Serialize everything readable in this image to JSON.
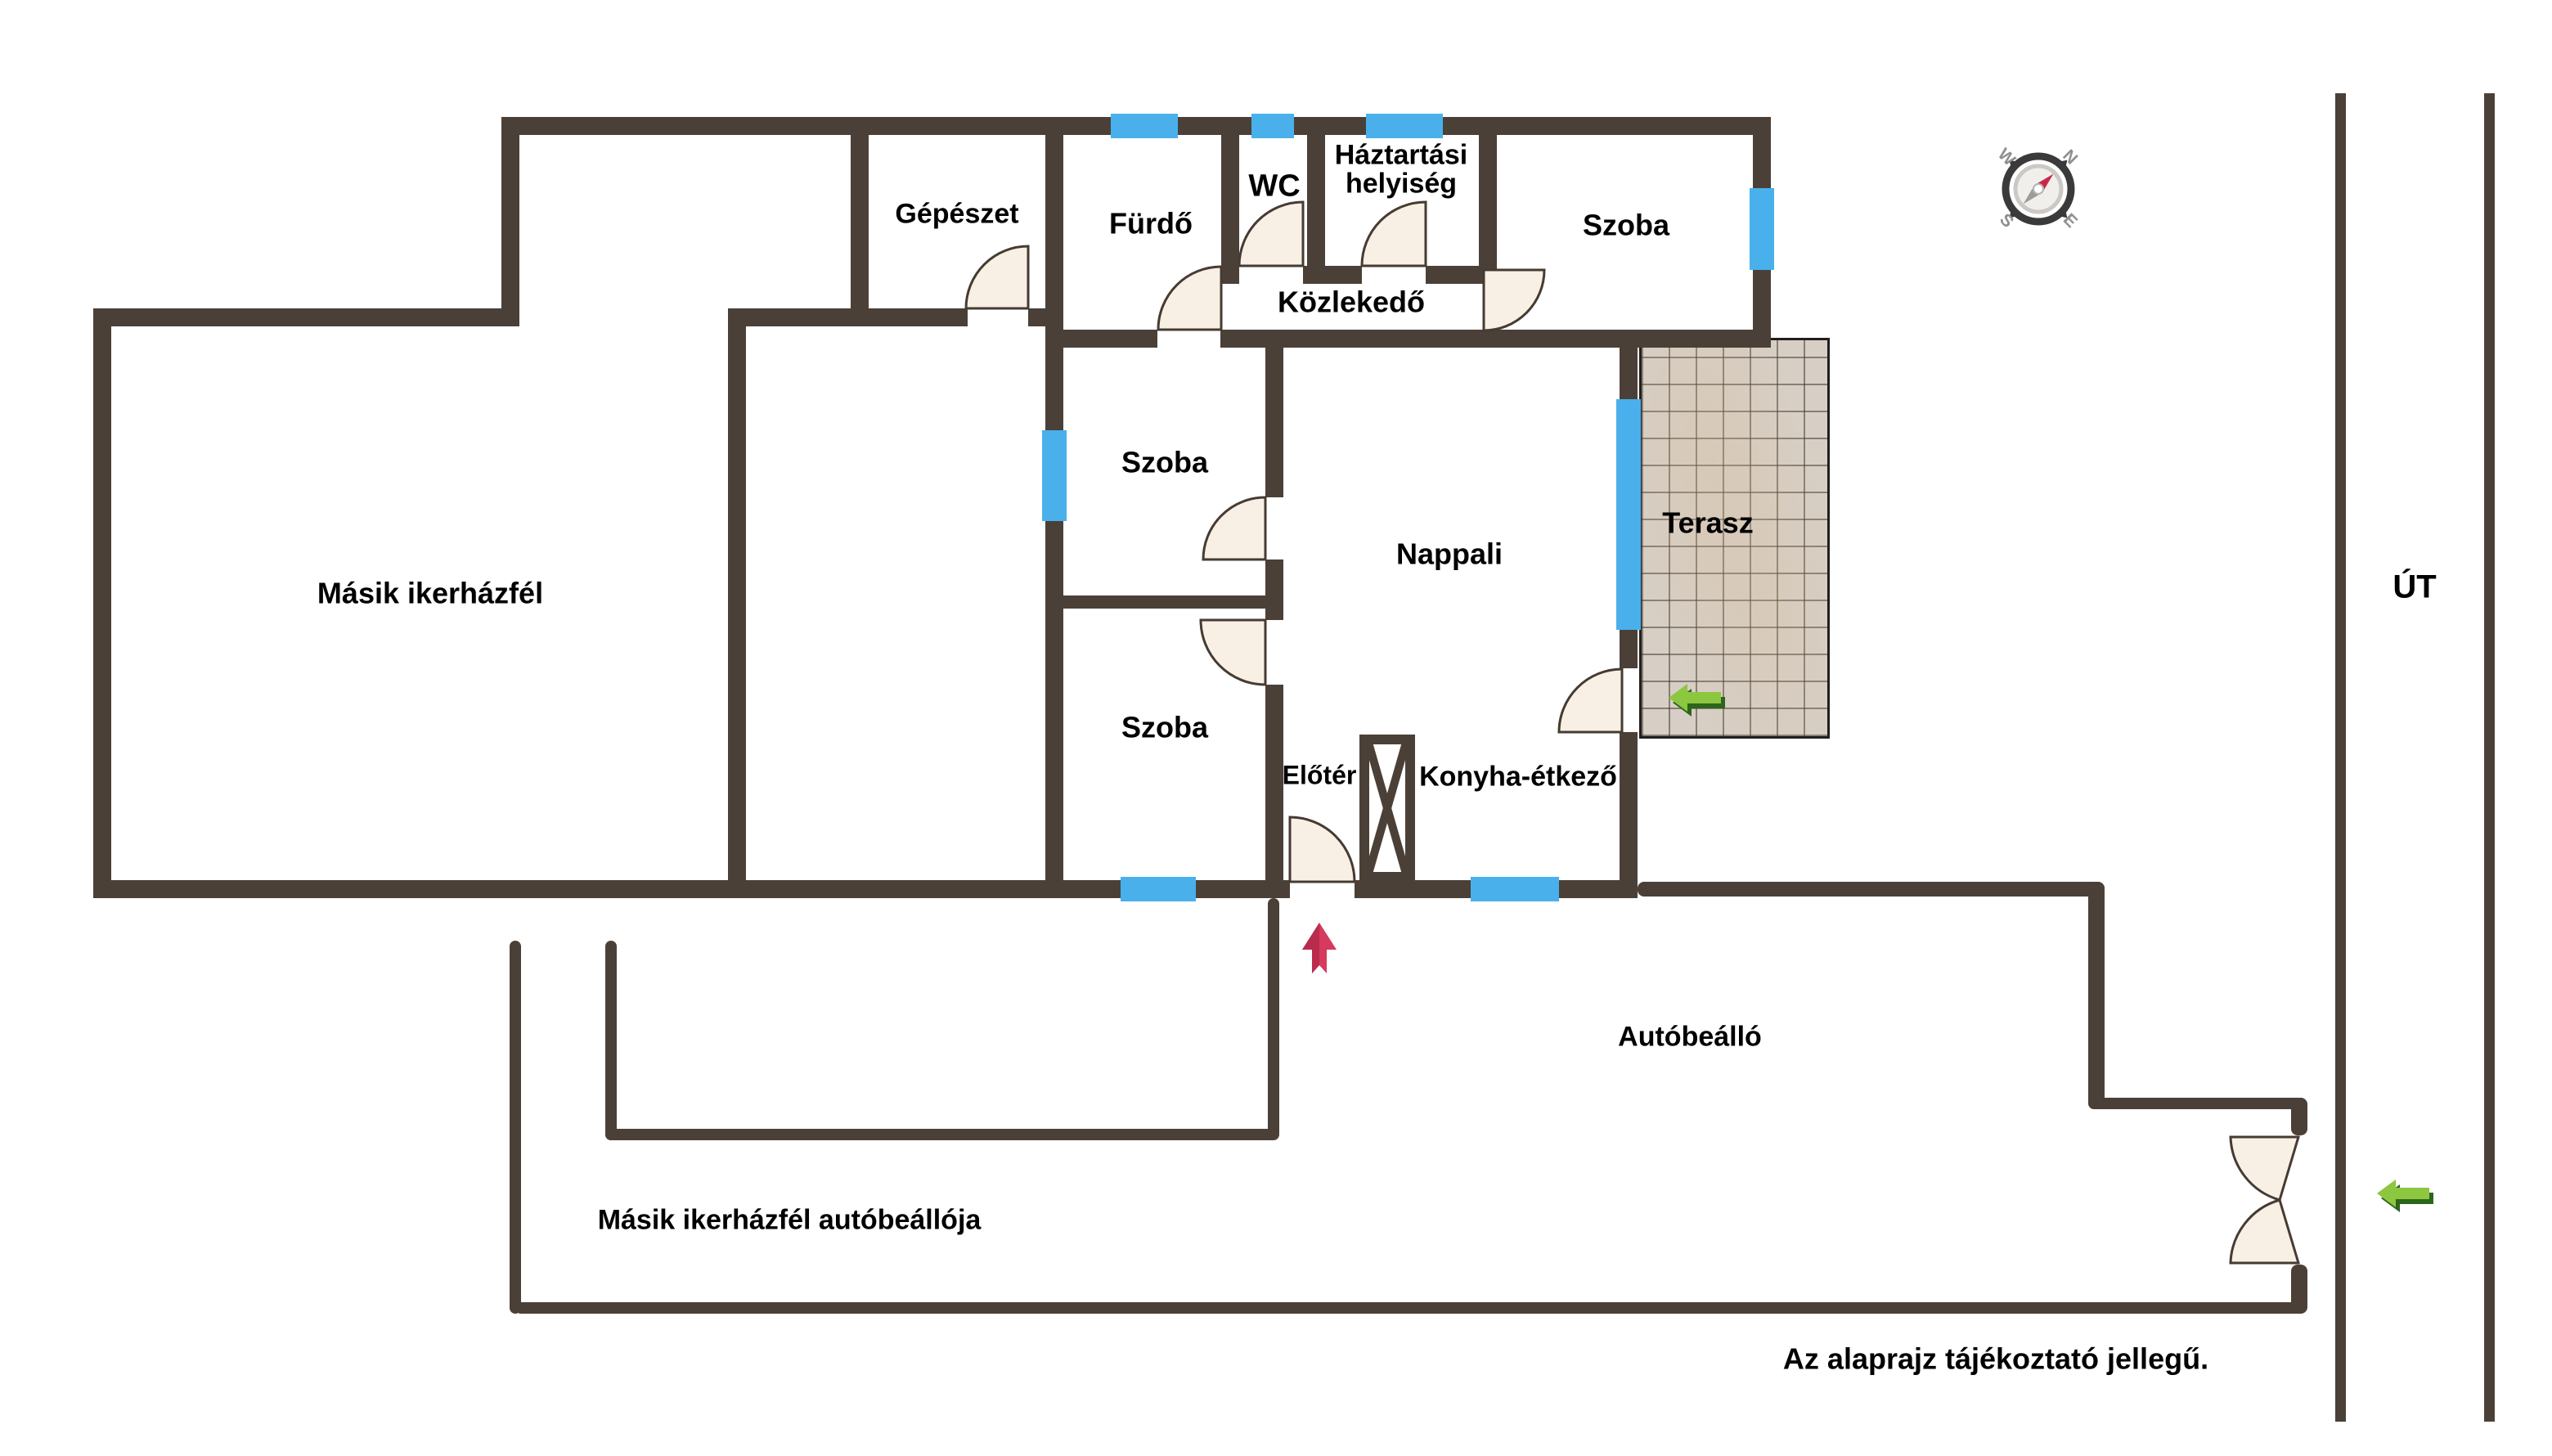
{
  "colors": {
    "wall": "#4b4037",
    "window": "#49b0ec",
    "door_fill": "#f8f0e4",
    "terrace_tile": "#d7cfc6",
    "entrance_arrow_red": "#d63a5c",
    "direction_arrow_green": "#8dc63f",
    "compass_needle_red": "#c8294b"
  },
  "rooms": [
    {
      "id": "masik-ikerhazfel",
      "label": "Másik ikerházfél"
    },
    {
      "id": "gepeszet",
      "label": "Gépészet"
    },
    {
      "id": "furdo",
      "label": "Fürdő"
    },
    {
      "id": "wc",
      "label": "WC"
    },
    {
      "id": "haztartasi-helyiseg",
      "label_line1": "Háztartási",
      "label_line2": "helyiség"
    },
    {
      "id": "szoba-eszaki",
      "label": "Szoba"
    },
    {
      "id": "kozlekedo",
      "label": "Közlekedő"
    },
    {
      "id": "szoba-kozepso",
      "label": "Szoba"
    },
    {
      "id": "nappali",
      "label": "Nappali"
    },
    {
      "id": "terasz",
      "label": "Terasz"
    },
    {
      "id": "szoba-also",
      "label": "Szoba"
    },
    {
      "id": "eloter",
      "label": "Előtér"
    },
    {
      "id": "konyha-etkezo",
      "label": "Konyha-étkező"
    }
  ],
  "outdoor": {
    "autobeallo": "Autóbeálló",
    "masik_autobeallo": "Másik ikerházfél autóbeállója",
    "ut": "ÚT",
    "disclaimer": "Az alaprajz tájékoztató jellegű."
  },
  "compass": {
    "n": "N",
    "e": "E",
    "s": "S",
    "w": "W"
  }
}
